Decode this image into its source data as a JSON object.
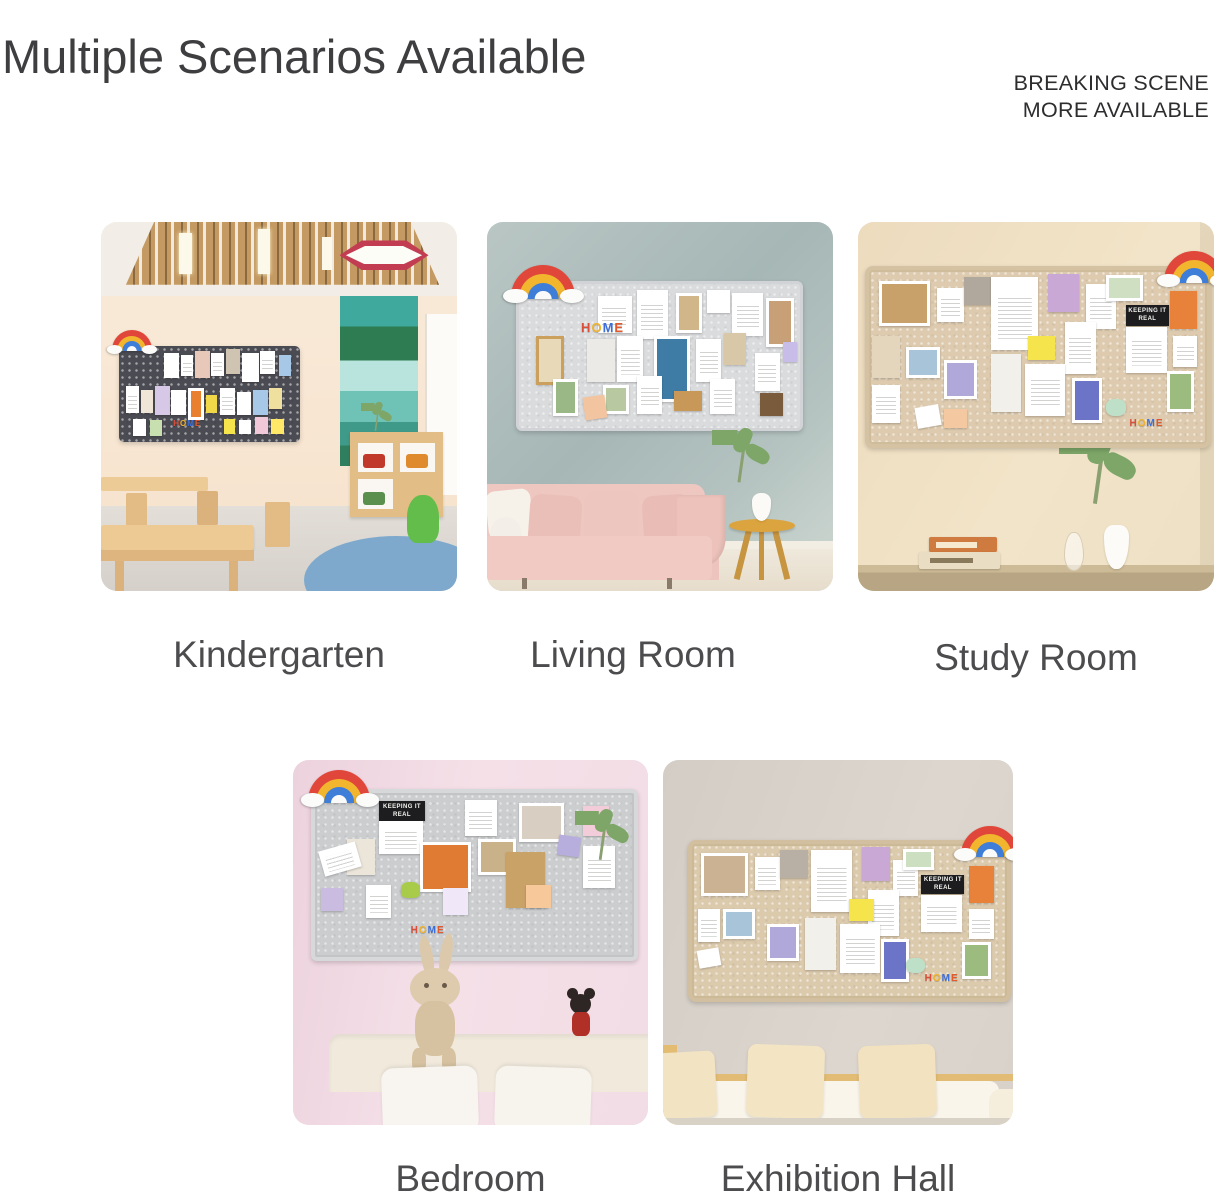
{
  "header": {
    "title": "Multiple Scenarios Available",
    "promo_line1": "BREAKING SCENE",
    "promo_line2": "MORE AVAILABLE"
  },
  "scenes": [
    {
      "label": "Kindergarten",
      "board_text": "HOME"
    },
    {
      "label": "Living Room",
      "board_text": "HOME"
    },
    {
      "label": "Study Room",
      "board_text": "HOME",
      "board_card_text": "KEEPING IT REAL"
    },
    {
      "label": "Bedroom",
      "board_text": "HOME",
      "board_card_text": "KEEPING IT REAL"
    },
    {
      "label": "Exhibition Hall",
      "board_text": "HOME",
      "board_card_text": "KEEPING IT REAL"
    }
  ],
  "colors": {
    "title_text": "#3e3e40",
    "label_text": "#4c4c4e",
    "promo_text": "#2d2d2f",
    "rainbow_red": "#e0473a",
    "rainbow_yellow": "#f2b52e",
    "rainbow_blue": "#3e7ed8",
    "kindergarten_board": "#4b4b53",
    "living_room_board": "#dadbdd",
    "study_board": "#decbaf",
    "bedroom_board": "#cbcdcf",
    "exhibition_board": "#dccaad"
  }
}
